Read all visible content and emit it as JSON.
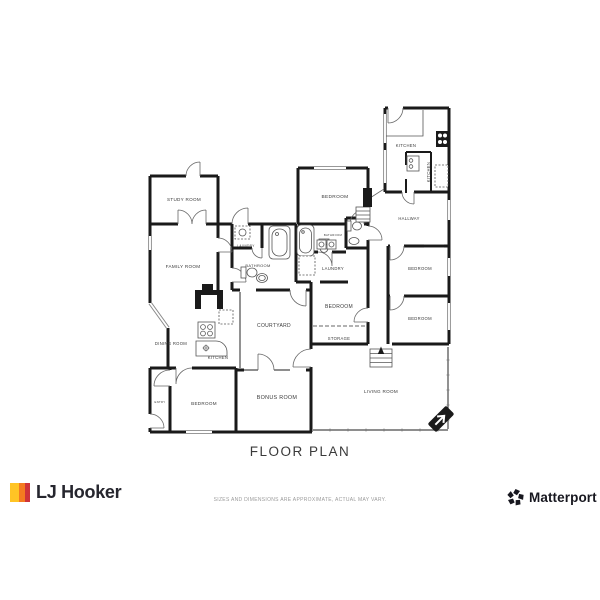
{
  "plan": {
    "title": "FLOOR PLAN",
    "rooms": [
      {
        "id": "study-room",
        "label": "STUDY ROOM"
      },
      {
        "id": "family-room",
        "label": "FAMILY ROOM"
      },
      {
        "id": "laundry-closet",
        "label": "LAUNDRY"
      },
      {
        "id": "bathroom-west",
        "label": "BATHROOM"
      },
      {
        "id": "bedroom-north",
        "label": "BEDROOM"
      },
      {
        "id": "bathroom-mid",
        "label": "BATHROOM"
      },
      {
        "id": "laundry-central",
        "label": "LAUNDRY"
      },
      {
        "id": "bedroom-central",
        "label": "BEDROOM"
      },
      {
        "id": "storage",
        "label": "STORAGE"
      },
      {
        "id": "courtyard",
        "label": "COURTYARD"
      },
      {
        "id": "dining-room",
        "label": "DINING ROOM"
      },
      {
        "id": "kitchen-west",
        "label": "KITCHEN"
      },
      {
        "id": "entry",
        "label": "ENTRY"
      },
      {
        "id": "bedroom-southwest",
        "label": "BEDROOM"
      },
      {
        "id": "bonus-room",
        "label": "BONUS ROOM"
      },
      {
        "id": "living-room",
        "label": "LIVING ROOM"
      },
      {
        "id": "kitchen-northeast",
        "label": "KITCHEN"
      },
      {
        "id": "kitchen-pantry",
        "label": "KITCHEN"
      },
      {
        "id": "hallway",
        "label": "HALLWAY"
      },
      {
        "id": "bedroom-east-1",
        "label": "BEDROOM"
      },
      {
        "id": "bedroom-east-2",
        "label": "BEDROOM"
      }
    ]
  },
  "footer": {
    "brand": "LJ Hooker",
    "disclaimer": "SIZES AND DIMENSIONS ARE APPROXIMATE, ACTUAL MAY VARY.",
    "matterport": "Matterport",
    "matterport_reg": "®"
  },
  "colors": {
    "wall": "#1a1a1a",
    "lj_yellow": "#FFC425",
    "lj_orange": "#F47B20",
    "lj_red": "#CF3339",
    "brand_text": "#26262e",
    "matterport_text": "#17171f",
    "label_text": "#3a3a3a",
    "disclaimer_text": "#9a9a9a"
  }
}
